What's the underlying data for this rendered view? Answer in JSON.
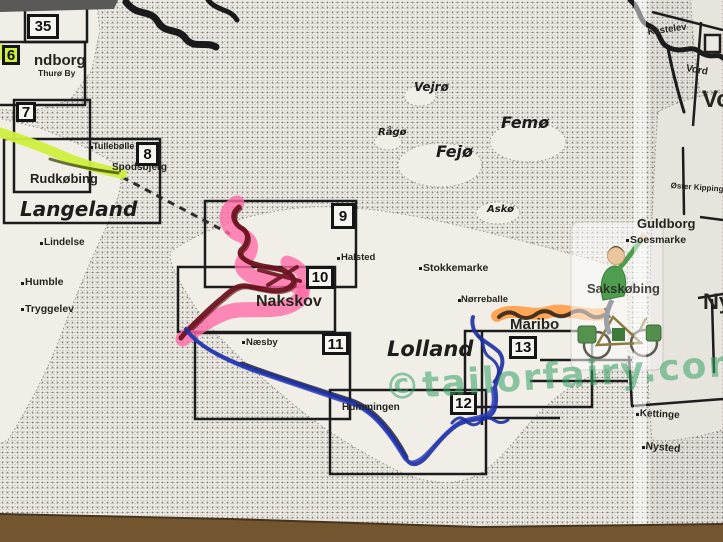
{
  "photo": {
    "desc": "Photo of a folded paper cycling-map index sheet of Lolland / Langeland (Denmark) with hand-highlighted routes",
    "paper_color": "#edeae4",
    "table_top_color": "#5a5955",
    "table_bottom_color": "#73552f"
  },
  "watermark": {
    "text": "©tailorfairy.com",
    "color": "#37a164"
  },
  "sheets": {
    "s35": "35",
    "s6": "6",
    "s7": "7",
    "s8": "8",
    "s9": "9",
    "s10": "10",
    "s11": "11",
    "s12": "12",
    "s13": "13"
  },
  "regions": {
    "langeland": "Langeland",
    "lolland": "Lolland"
  },
  "islands": {
    "vejro": "Vejrø",
    "raago": "Rågø",
    "fejo": "Fejø",
    "femo": "Femø",
    "asko": "Askø"
  },
  "towns": {
    "svendborg_partial": "ndborg",
    "thuro_by": "Thurø By",
    "tullebolle": "Tullebølle",
    "spodsbjerg": "Spodsbjerg",
    "rudkobing": "Rudkøbing",
    "lindelse": "Lindelse",
    "humble": "Humble",
    "tryggelev": "Tryggelev",
    "halsted": "Halsted",
    "stokkemarke": "Stokkemarke",
    "nakskov": "Nakskov",
    "naesby": "Næsby",
    "norreballe": "Nørreballe",
    "maribo": "Maribo",
    "hummingen": "Hummingen",
    "kettinge": "Kettinge",
    "nysted": "Nysted",
    "guldborg": "Guldborg",
    "soesmarke": "Soesmarke",
    "sakskobing": "Sakskøbing",
    "oster_kippinge": "Øster Kippinge",
    "kastelev": "Kastelev",
    "vordingborg_partial": "Vord",
    "vo_partial": "Vo",
    "nykobing_partial": "Ny"
  },
  "routes": {
    "green": {
      "label": "yellow-green highlighter route near Rudkøbing–Spodsbjerg",
      "color": "#cdef3f"
    },
    "pink": {
      "label": "pink highlighter route Tårs–Nakskov",
      "color": "#ff6ba6"
    },
    "maroon": {
      "label": "dark-red marker route drawn over pink",
      "color": "#6b1420"
    },
    "blue": {
      "label": "blue ballpoint route Nakskov–Maribo",
      "color": "#1d2f9f"
    },
    "orange": {
      "label": "orange highlighter route Maribo–Sakskøbing",
      "color": "#ff9d45"
    }
  },
  "ferry": {
    "label": "dashed ferry line Spodsbjerg–Tårs"
  },
  "clipart": {
    "label": "cyclist clipart sticker"
  }
}
